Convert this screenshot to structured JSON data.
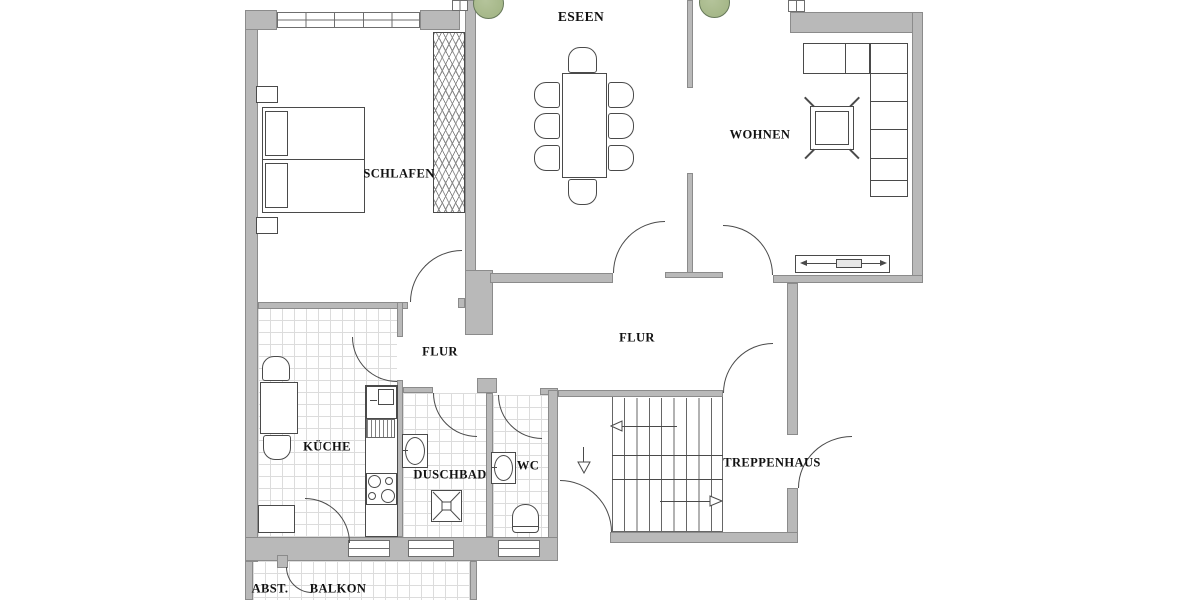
{
  "title": "Wohnung Grundriss",
  "rooms": {
    "essen": {
      "label": "ESEEN"
    },
    "schlafen": {
      "label": "SCHLAFEN"
    },
    "wohnen": {
      "label": "WOHNEN"
    },
    "flur_small": {
      "label": "FLUR"
    },
    "flur_main": {
      "label": "FLUR"
    },
    "kueche": {
      "label": "KÜCHE"
    },
    "duschbad": {
      "label": "DUSCHBAD"
    },
    "wc": {
      "label": "WC"
    },
    "treppenhaus": {
      "label": "TREPPENHAUS"
    },
    "abstellraum": {
      "label": "ABST."
    },
    "balkon": {
      "label": "BALKON"
    }
  },
  "icons": {
    "trees": [
      "tree-icon",
      "tree-icon"
    ],
    "stair_arrows": [
      "arrow-left",
      "arrow-down",
      "arrow-right"
    ]
  },
  "colors": {
    "background": "#ffffff",
    "wall": "#b9b9b9",
    "wall_outline": "#8b8b8b",
    "line": "#4a4a4a",
    "tile": "#dcdcdc",
    "label": "#111111",
    "tree_fill": "#9fb281",
    "tree_outline": "#67795a"
  }
}
